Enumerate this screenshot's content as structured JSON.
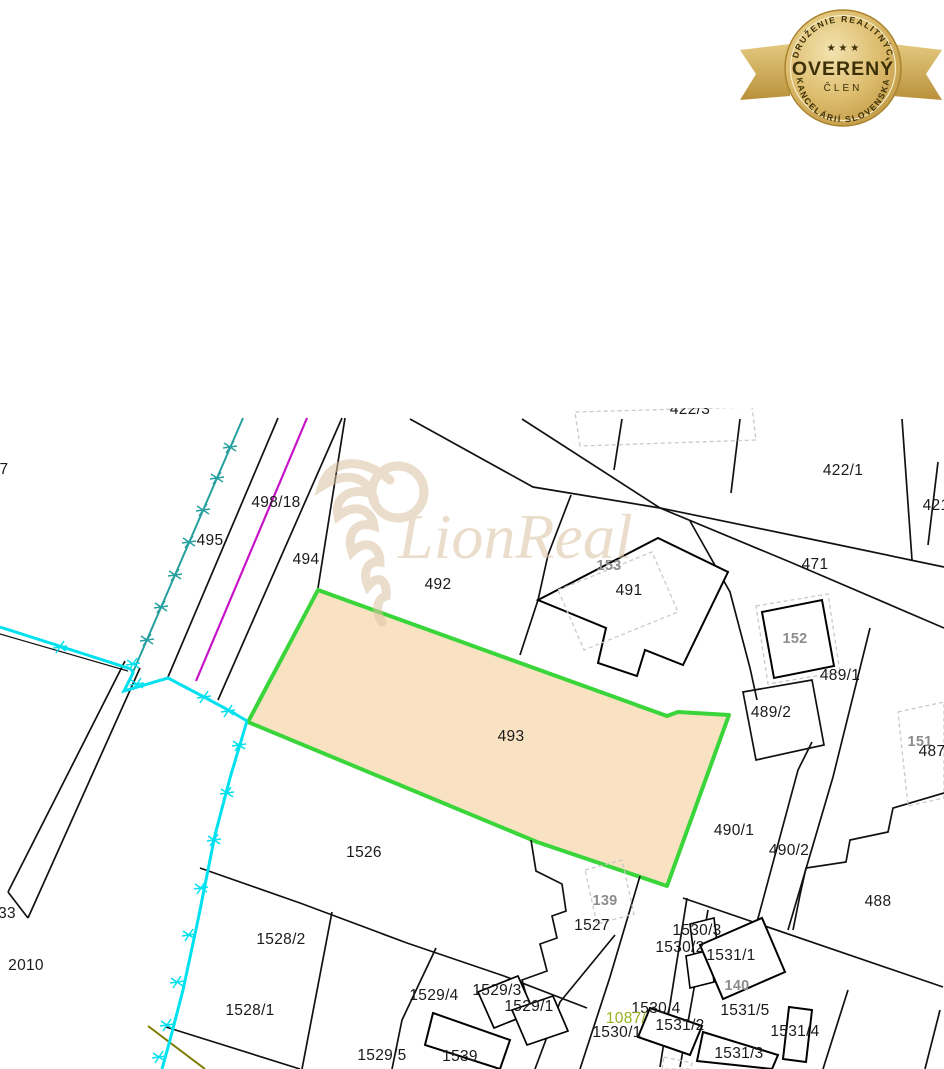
{
  "badge": {
    "top_arc": "ZDRUŽENIE REALITNÝCH",
    "bottom_arc": "KANCELÁRIÍ SLOVENSKA",
    "stars": "★ ★ ★",
    "center": "OVERENÝ",
    "sub": "ČLEN",
    "gold": "#c9a84c",
    "dark_text": "#3d3008"
  },
  "watermark": {
    "text": "LionReal",
    "color": "#dcc3a3"
  },
  "map": {
    "colors": {
      "highlight_fill": "#f8e2c2",
      "highlight_stroke": "#3ad53a",
      "cyan_line": "#00e1ef",
      "teal_line": "#279f9f",
      "magenta_line": "#c713c7",
      "olive_line": "#7b7b00",
      "building_label": "#8c8c8c",
      "waterway_label": "#97b321"
    },
    "highlighted_parcel": "493",
    "labels": [
      {
        "t": "7",
        "x": 4,
        "y": 470,
        "k": "p"
      },
      {
        "t": "495",
        "x": 210,
        "y": 541,
        "k": "p"
      },
      {
        "t": "498/18",
        "x": 276,
        "y": 503,
        "k": "p"
      },
      {
        "t": "494",
        "x": 306,
        "y": 560,
        "k": "p"
      },
      {
        "t": "492",
        "x": 438,
        "y": 585,
        "k": "p"
      },
      {
        "t": "422/3",
        "x": 690,
        "y": 410,
        "k": "p"
      },
      {
        "t": "422/1",
        "x": 843,
        "y": 471,
        "k": "p"
      },
      {
        "t": "421",
        "x": 936,
        "y": 506,
        "k": "p"
      },
      {
        "t": "471",
        "x": 815,
        "y": 565,
        "k": "p"
      },
      {
        "t": "153",
        "x": 609,
        "y": 566,
        "k": "b"
      },
      {
        "t": "491",
        "x": 629,
        "y": 591,
        "k": "p"
      },
      {
        "t": "152",
        "x": 795,
        "y": 639,
        "k": "b"
      },
      {
        "t": "489/1",
        "x": 840,
        "y": 676,
        "k": "p"
      },
      {
        "t": "489/2",
        "x": 771,
        "y": 713,
        "k": "p"
      },
      {
        "t": "151",
        "x": 920,
        "y": 742,
        "k": "b"
      },
      {
        "t": "487",
        "x": 932,
        "y": 752,
        "k": "p"
      },
      {
        "t": "493",
        "x": 511,
        "y": 737,
        "k": "p"
      },
      {
        "t": "490/1",
        "x": 734,
        "y": 831,
        "k": "p"
      },
      {
        "t": "490/2",
        "x": 789,
        "y": 851,
        "k": "p"
      },
      {
        "t": "488",
        "x": 878,
        "y": 902,
        "k": "p"
      },
      {
        "t": "1526",
        "x": 364,
        "y": 853,
        "k": "p"
      },
      {
        "t": "139",
        "x": 605,
        "y": 901,
        "k": "b"
      },
      {
        "t": "1527",
        "x": 592,
        "y": 926,
        "k": "p"
      },
      {
        "t": "1528/2",
        "x": 281,
        "y": 940,
        "k": "p"
      },
      {
        "t": "33",
        "x": 7,
        "y": 914,
        "k": "p"
      },
      {
        "t": "2010",
        "x": 26,
        "y": 966,
        "k": "p"
      },
      {
        "t": "1528/1",
        "x": 250,
        "y": 1011,
        "k": "p"
      },
      {
        "t": "1529/4",
        "x": 434,
        "y": 996,
        "k": "p"
      },
      {
        "t": "1529/3",
        "x": 497,
        "y": 991,
        "k": "p"
      },
      {
        "t": "1529/1",
        "x": 529,
        "y": 1007,
        "k": "p"
      },
      {
        "t": "1529/5",
        "x": 382,
        "y": 1056,
        "k": "p"
      },
      {
        "t": "1539",
        "x": 460,
        "y": 1057,
        "k": "p"
      },
      {
        "t": "1530/3",
        "x": 697,
        "y": 931,
        "k": "p"
      },
      {
        "t": "1530/2",
        "x": 680,
        "y": 948,
        "k": "p"
      },
      {
        "t": "1531/1",
        "x": 731,
        "y": 956,
        "k": "p"
      },
      {
        "t": "140",
        "x": 737,
        "y": 986,
        "k": "b"
      },
      {
        "t": "1530/4",
        "x": 656,
        "y": 1009,
        "k": "p"
      },
      {
        "t": "1531/5",
        "x": 745,
        "y": 1011,
        "k": "p"
      },
      {
        "t": "1087/",
        "x": 626,
        "y": 1019,
        "k": "g"
      },
      {
        "t": "1531/2",
        "x": 680,
        "y": 1026,
        "k": "p"
      },
      {
        "t": "1530/1",
        "x": 617,
        "y": 1033,
        "k": "p"
      },
      {
        "t": "1531/4",
        "x": 795,
        "y": 1032,
        "k": "p"
      },
      {
        "t": "1531/3",
        "x": 739,
        "y": 1054,
        "k": "p"
      }
    ]
  }
}
